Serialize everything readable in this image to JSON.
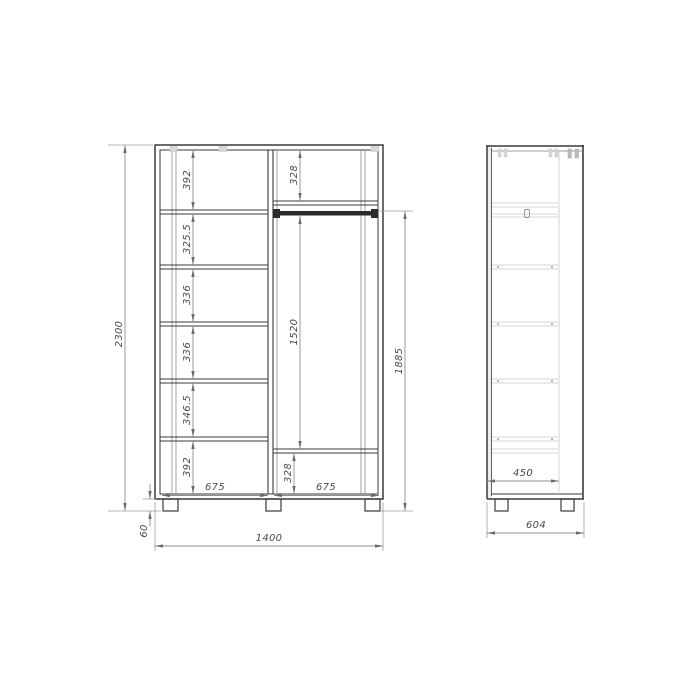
{
  "drawing": {
    "type": "furniture-technical-drawing",
    "front": {
      "overall_height": "2300",
      "overall_width": "1400",
      "leg_height": "60",
      "left_shelves": [
        "392",
        "325.5",
        "336",
        "336",
        "346.5",
        "392"
      ],
      "right_top": "328",
      "right_middle": "1520",
      "right_bottom": "328",
      "hang_zone": "1885",
      "bottom_left_width": "675",
      "bottom_right_width": "675"
    },
    "side": {
      "inner_depth": "450",
      "overall_depth": "604"
    }
  }
}
